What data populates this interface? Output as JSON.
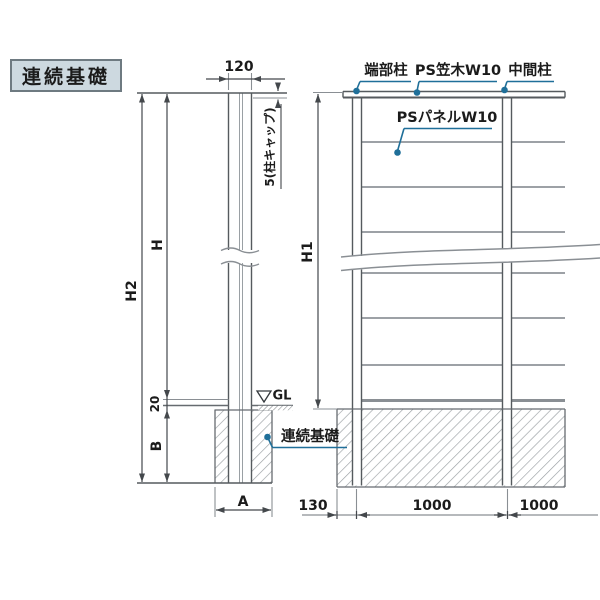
{
  "title": "連続基礎",
  "colors": {
    "leader": "#1f6f99",
    "line_dark": "#44484c",
    "line_gray": "#8a8f94",
    "hatch": "#9aa0a4",
    "title_bg": "#cdd9e0",
    "title_border": "#6e7a81",
    "text": "#1b1b1b"
  },
  "section_view": {
    "dim_post_width": "120",
    "dim_cap": "5(柱キャップ)",
    "dim_total_height": "H2",
    "dim_height_above_gl": "H",
    "dim_gl_offset": "20",
    "dim_foundation_depth": "B",
    "dim_foundation_width": "A",
    "gl_label": "GL",
    "foundation_label": "連続基礎"
  },
  "elevation_view": {
    "label_end_post": "端部柱",
    "label_cap": "PS笠木W10",
    "label_mid_post": "中間柱",
    "label_panel": "PSパネルW10",
    "dim_fence_height": "H1",
    "dim_edge_offset": "130",
    "dim_span_1": "1000",
    "dim_span_2": "1000"
  }
}
